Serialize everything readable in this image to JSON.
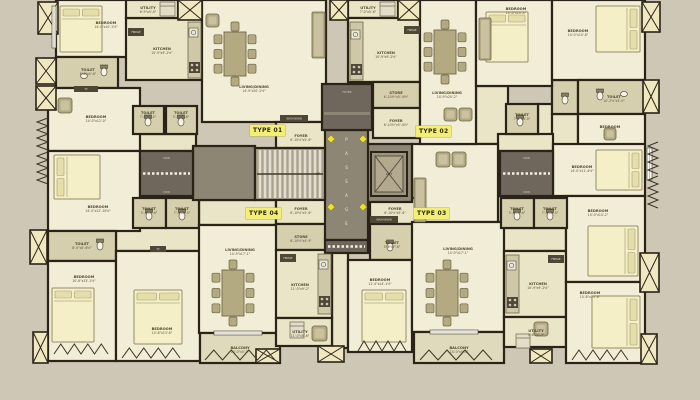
{
  "palette": {
    "bg": "#cec7b5",
    "wall": "#2b2317",
    "floor_light": "#f1edd6",
    "floor_pale": "#eae5c6",
    "floor_khaki": "#d6cfae",
    "floor_balcony": "#e0dabc",
    "gray": "#8e8674",
    "gray_dark": "#6f675b",
    "duct": "#efe8c0",
    "bed": "#f4efc6",
    "pillow": "#e4deab",
    "furn": "#b3aa82",
    "furn_light": "#c9c1a0",
    "furn_border": "#6d6548",
    "label_bg": "#f3ee76",
    "label_text": "#2e2713",
    "diamond": "#e8e23c",
    "room_text": "#51482f",
    "dark_bar": "#4e4736",
    "stair_tread": "#e2dfd2",
    "stair_base": "#aaa28c"
  },
  "plan": {
    "type_labels": [
      {
        "label": "TYPE 01",
        "x": 250,
        "y": 125
      },
      {
        "label": "TYPE 02",
        "x": 416,
        "y": 126
      },
      {
        "label": "TYPE 03",
        "x": 414,
        "y": 208
      },
      {
        "label": "TYPE 04",
        "x": 246,
        "y": 208
      }
    ],
    "core": {
      "passage": {
        "x": 325,
        "y": 130,
        "w": 43,
        "h": 110,
        "label": "PASSAGE"
      },
      "lobby": {
        "x": 322,
        "y": 84,
        "w": 50,
        "h": 46,
        "label": "FOYER"
      },
      "landing": {
        "x": 193,
        "y": 146,
        "w": 62,
        "h": 54
      },
      "lift_lobby": {
        "x": 366,
        "y": 144,
        "w": 46,
        "h": 58
      },
      "stairs": {
        "x": 255,
        "y": 148,
        "w": 70,
        "h": 52,
        "up_label": "UP"
      },
      "lift": {
        "x": 371,
        "y": 152,
        "w": 36,
        "h": 44,
        "label": "LIFT"
      },
      "voids": [
        {
          "x": 140,
          "y": 151,
          "w": 53,
          "h": 45
        },
        {
          "x": 500,
          "y": 151,
          "w": 53,
          "h": 45
        },
        {
          "x": 325,
          "y": 240,
          "w": 43,
          "h": 13
        }
      ],
      "void_label": "VOID"
    },
    "rooms": [
      [
        "P",
        133,
        134,
        63,
        17,
        "",
        "",
        0,
        0
      ],
      [
        "P",
        116,
        196,
        84,
        55,
        "",
        "",
        0,
        0
      ],
      [
        "P",
        199,
        200,
        77,
        25,
        "",
        "",
        0,
        0
      ],
      [
        "P",
        476,
        86,
        32,
        58,
        "",
        "",
        0,
        0
      ],
      [
        "P",
        538,
        104,
        40,
        47,
        "",
        "",
        0,
        0
      ],
      [
        "P",
        552,
        114,
        26,
        37,
        "",
        "",
        0,
        0
      ],
      [
        "P",
        498,
        134,
        55,
        17,
        "",
        "",
        0,
        0
      ],
      [
        "P",
        332,
        252,
        16,
        96,
        "",
        "",
        0,
        0
      ],
      [
        "P",
        501,
        228,
        65,
        23,
        "",
        "",
        0,
        0
      ],
      [
        "L",
        412,
        144,
        86,
        78,
        "",
        "",
        0,
        0
      ],
      [
        "K",
        552,
        80,
        26,
        34,
        "",
        "",
        0,
        0
      ],
      [
        "L",
        56,
        0,
        80,
        57,
        "BEDROOM",
        "14'-0\"x10'-1½\"",
        106,
        24
      ],
      [
        "K",
        56,
        57,
        62,
        31,
        "TOILET",
        "8'-0\"x5'-6\"",
        88,
        71
      ],
      [
        "P",
        126,
        18,
        76,
        62,
        "KITCHEN",
        "10'-9\"x9'-2½\"",
        162,
        50
      ],
      [
        "P",
        126,
        0,
        52,
        18,
        "UTILITY",
        "6'-9\"x5'-6\"",
        148,
        9
      ],
      [
        "L",
        202,
        0,
        124,
        122,
        "LIVING/DINING",
        "14'-9\"x20'-2½\"",
        254,
        88
      ],
      [
        "L",
        48,
        88,
        92,
        63,
        "BEDROOM",
        "14'-0\"x12'-0\"",
        96,
        118
      ],
      [
        "P",
        276,
        122,
        50,
        26,
        "FOYER",
        "6'-10½\"x5'-6\"",
        301,
        137
      ],
      [
        "K",
        133,
        106,
        31,
        28,
        "TOILET",
        "7'-0\"x5'-0\"",
        148,
        114
      ],
      [
        "K",
        166,
        106,
        31,
        28,
        "TOILET",
        "5'-6\"x7'-6\"",
        181,
        114
      ],
      [
        "P",
        348,
        0,
        50,
        18,
        "UTILITY",
        "7'-0\"x5'-6\"",
        368,
        9
      ],
      [
        "P",
        348,
        18,
        72,
        64,
        "KITCHEN",
        "10'-9\"x9'-2½\"",
        386,
        54
      ],
      [
        "K",
        373,
        82,
        47,
        26,
        "STORE",
        "6'-10½\"x5'-4½\"",
        396,
        94
      ],
      [
        "P",
        373,
        108,
        47,
        30,
        "FOYER",
        "6'-10½\"x5'-4½\"",
        396,
        122
      ],
      [
        "L",
        420,
        0,
        56,
        144,
        "LIVING/DINING",
        "14'-9\"x20'-2\"",
        447,
        94
      ],
      [
        "L",
        476,
        0,
        76,
        86,
        "BEDROOM",
        "14'-0\"x10'-0\"",
        516,
        10
      ],
      [
        "L",
        552,
        0,
        93,
        80,
        "BEDROOM",
        "14'-0\"x10'-8\"",
        578,
        32
      ],
      [
        "K",
        578,
        80,
        67,
        34,
        "TOILET",
        "10'-2½\"x5'-0\"",
        614,
        98
      ],
      [
        "L",
        578,
        114,
        67,
        37,
        "BEDROOM",
        "",
        610,
        128
      ],
      [
        "K",
        506,
        104,
        32,
        30,
        "TOILET",
        "7'-2\"x8'-0\"",
        522,
        116
      ],
      [
        "L",
        48,
        151,
        92,
        80,
        "BEDROOM",
        "14'-0\"x12'-10½\"",
        98,
        208
      ],
      [
        "K",
        48,
        231,
        68,
        30,
        "TOILET",
        "8'-0\"x5'-6½\"",
        82,
        245
      ],
      [
        "L",
        48,
        261,
        68,
        100,
        "BEDROOM",
        "10'-6\"x13'-1½\"",
        84,
        278
      ],
      [
        "L",
        116,
        251,
        84,
        110,
        "BEDROOM",
        "10'-8\"x13'-8\"",
        162,
        330
      ],
      [
        "K",
        133,
        198,
        33,
        30,
        "TOILET",
        "5'-6\"x7'-6\"",
        149,
        210
      ],
      [
        "K",
        166,
        198,
        33,
        30,
        "TOILET",
        "7'-0\"x5'-0\"",
        182,
        210
      ],
      [
        "L",
        199,
        225,
        78,
        108,
        "LIVING/DINING",
        "14'-9\"x17'-1\"",
        240,
        251
      ],
      [
        "B",
        200,
        333,
        80,
        30,
        "BALCONY",
        "14'-0\"x5'-0\"",
        240,
        349
      ],
      [
        "P",
        276,
        198,
        50,
        26,
        "FOYER",
        "6'-10½\"x5'-6\"",
        301,
        210
      ],
      [
        "K",
        276,
        224,
        50,
        26,
        "STORE",
        "6'-10½\"x4'-9\"",
        301,
        238
      ],
      [
        "P",
        276,
        250,
        56,
        68,
        "KITCHEN",
        "11'-0\"x9'-2\"",
        300,
        286
      ],
      [
        "P",
        276,
        318,
        56,
        28,
        "UTILITY",
        "11'-0\"x5'-6\"",
        300,
        333
      ],
      [
        "P",
        370,
        198,
        50,
        26,
        "FOYER",
        "6'-10½\"x5'-6\"",
        395,
        210
      ],
      [
        "K",
        370,
        224,
        50,
        36,
        "TOILET",
        "5'-6\"x7'-6\"",
        392,
        244
      ],
      [
        "L",
        348,
        260,
        64,
        92,
        "BEDROOM",
        "11'-4\"x14'-1½\"",
        380,
        281
      ],
      [
        "L",
        412,
        222,
        92,
        110,
        "LIVING/DINING",
        "14'-9\"x17'-1\"",
        458,
        250
      ],
      [
        "B",
        414,
        332,
        90,
        31,
        "BALCONY",
        "14'-0\"x5'-0\"",
        459,
        349
      ],
      [
        "P",
        504,
        251,
        62,
        66,
        "KITCHEN",
        "10'-9\"x9'-2½\"",
        538,
        285
      ],
      [
        "P",
        504,
        317,
        62,
        30,
        "UTILITY",
        "5'-6\"x4'-9\"",
        536,
        332
      ],
      [
        "L",
        553,
        144,
        92,
        52,
        "BEDROOM",
        "14'-0\"x11'-4½\"",
        582,
        168
      ],
      [
        "L",
        566,
        196,
        79,
        86,
        "BEDROOM",
        "14'-0\"x14'-2\"",
        598,
        212
      ],
      [
        "L",
        566,
        282,
        79,
        81,
        "BEDROOM",
        "10'-8\"x13'-8\"",
        590,
        294
      ],
      [
        "K",
        501,
        198,
        33,
        30,
        "TOILET",
        "5'-6\"x7'-6\"",
        517,
        210
      ],
      [
        "K",
        534,
        198,
        33,
        30,
        "TOILET",
        "7'-0\"x5'-0\"",
        550,
        210
      ]
    ],
    "ducts": [
      [
        38,
        2,
        20,
        32
      ],
      [
        36,
        58,
        20,
        26
      ],
      [
        36,
        86,
        20,
        24
      ],
      [
        30,
        230,
        17,
        34
      ],
      [
        33,
        332,
        15,
        31
      ],
      [
        642,
        2,
        18,
        30
      ],
      [
        643,
        80,
        16,
        33
      ],
      [
        640,
        253,
        19,
        39
      ],
      [
        641,
        334,
        16,
        30
      ],
      [
        178,
        0,
        24,
        20
      ],
      [
        398,
        0,
        22,
        20
      ],
      [
        330,
        0,
        18,
        20
      ],
      [
        318,
        346,
        26,
        16
      ],
      [
        256,
        349,
        24,
        14
      ],
      [
        530,
        349,
        22,
        14
      ]
    ],
    "furniture": [
      [
        "bed",
        60,
        6,
        42,
        46,
        "n"
      ],
      [
        "bed",
        486,
        12,
        42,
        50,
        "n"
      ],
      [
        "bed",
        596,
        6,
        44,
        46,
        "e"
      ],
      [
        "bed",
        54,
        155,
        46,
        44,
        "w"
      ],
      [
        "bed",
        52,
        288,
        42,
        54,
        "n"
      ],
      [
        "bed",
        134,
        290,
        48,
        54,
        "n"
      ],
      [
        "bed",
        362,
        290,
        44,
        52,
        "n"
      ],
      [
        "bed",
        596,
        150,
        46,
        40,
        "e"
      ],
      [
        "bed",
        588,
        226,
        50,
        50,
        "e"
      ],
      [
        "bed",
        592,
        296,
        48,
        52,
        "e"
      ],
      [
        "table",
        224,
        32,
        22,
        44
      ],
      [
        "table",
        434,
        30,
        22,
        44
      ],
      [
        "table",
        222,
        270,
        22,
        46
      ],
      [
        "table",
        436,
        270,
        22,
        46
      ],
      [
        "sofa",
        312,
        12,
        13,
        46
      ],
      [
        "sofa",
        479,
        18,
        12,
        42
      ],
      [
        "sofa",
        414,
        178,
        12,
        44
      ],
      [
        "cb",
        206,
        14,
        13,
        13
      ],
      [
        "cb",
        58,
        98,
        14,
        15
      ],
      [
        "cb",
        444,
        108,
        13,
        13
      ],
      [
        "cb",
        459,
        108,
        13,
        13
      ],
      [
        "cb",
        436,
        152,
        14,
        15
      ],
      [
        "cb",
        452,
        152,
        14,
        15
      ],
      [
        "cb",
        312,
        326,
        15,
        15
      ],
      [
        "cb",
        534,
        322,
        14,
        14
      ],
      [
        "cb",
        604,
        128,
        12,
        12
      ],
      [
        "counter",
        188,
        22,
        13,
        56
      ],
      [
        "stove",
        189,
        62
      ],
      [
        "sink",
        189,
        28
      ],
      [
        "counter",
        350,
        22,
        13,
        58
      ],
      [
        "stove",
        351,
        64
      ],
      [
        "sink",
        351,
        30
      ],
      [
        "counter",
        318,
        254,
        13,
        60
      ],
      [
        "stove",
        319,
        296
      ],
      [
        "sink",
        319,
        260
      ],
      [
        "counter",
        506,
        255,
        13,
        58
      ],
      [
        "stove",
        507,
        297
      ],
      [
        "sink",
        507,
        261
      ],
      [
        "app",
        160,
        2,
        15,
        14
      ],
      [
        "app",
        380,
        2,
        15,
        14
      ],
      [
        "app",
        290,
        322,
        14,
        16
      ],
      [
        "app",
        516,
        334,
        14,
        14
      ],
      [
        "wc",
        104,
        72
      ],
      [
        "wc",
        148,
        122
      ],
      [
        "wc",
        181,
        122
      ],
      [
        "wc",
        100,
        246
      ],
      [
        "wc",
        149,
        216
      ],
      [
        "wc",
        182,
        216
      ],
      [
        "wc",
        390,
        247
      ],
      [
        "wc",
        517,
        216
      ],
      [
        "wc",
        550,
        216
      ],
      [
        "wc",
        520,
        122
      ],
      [
        "wc",
        565,
        100
      ],
      [
        "wc",
        600,
        96
      ],
      [
        "basin",
        84,
        76
      ],
      [
        "basin",
        624,
        94
      ]
    ],
    "bars": [
      [
        128,
        28,
        16,
        8,
        "FRIDGE"
      ],
      [
        404,
        26,
        16,
        8,
        "FRIDGE"
      ],
      [
        280,
        254,
        16,
        8,
        "FRIDGE"
      ],
      [
        548,
        255,
        16,
        8,
        "FRIDGE"
      ],
      [
        280,
        115,
        28,
        7,
        "WASH BASIN"
      ],
      [
        370,
        216,
        28,
        7,
        "WASH BASIN"
      ],
      [
        150,
        246,
        16,
        6,
        "TV"
      ],
      [
        74,
        86,
        24,
        6,
        "TV"
      ]
    ],
    "windows": [
      [
        52,
        6,
        4,
        42
      ],
      [
        214,
        331,
        48,
        4
      ],
      [
        430,
        330,
        48,
        4
      ],
      [
        647,
        148,
        5,
        32
      ]
    ],
    "zigzags": [
      [
        205,
        350,
        70,
        10
      ],
      [
        420,
        350,
        72,
        10
      ],
      [
        54,
        344,
        54,
        10
      ],
      [
        122,
        348,
        58,
        10
      ],
      [
        358,
        341,
        48,
        10
      ],
      [
        572,
        350,
        56,
        10
      ],
      [
        37,
        118,
        11,
        32
      ],
      [
        37,
        152,
        11,
        32
      ],
      [
        648,
        142,
        10,
        32
      ],
      [
        648,
        176,
        10,
        32
      ]
    ],
    "diamonds": [
      [
        331,
        139
      ],
      [
        363,
        139
      ],
      [
        331,
        207
      ],
      [
        363,
        207
      ]
    ]
  }
}
